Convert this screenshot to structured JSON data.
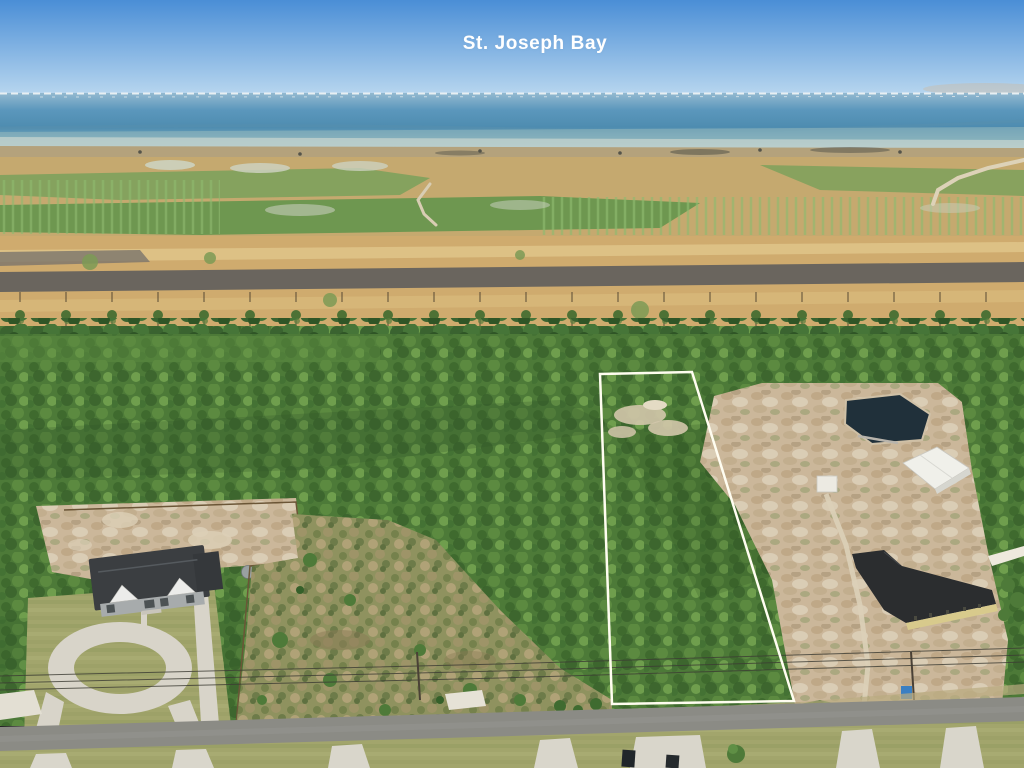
{
  "scene": {
    "type": "aerial-drone-photo",
    "title": "St. Joseph Bay",
    "subject": "Aerial view of a vacant wooded land parcel outlined in white, with St. Joseph Bay on the horizon, a house with circular driveway at lower left, cleared sand lots with metal buildings and a pond at right, and a paved road along the bottom"
  },
  "overlay": {
    "bay_label": "St. Joseph Bay",
    "boundary_points": "600,374 692,372 794,701 612,704"
  },
  "colors": {
    "sky_top": "#4a8ed6",
    "sky_horizon": "#b9d7ef",
    "water_far": "#93b9d0",
    "water_deep": "#4e8cb0",
    "water_nearshore": "#a9c6c6",
    "marsh_tan": "#cfab6e",
    "burned_strip": "#6a655e",
    "forest_green": "#4d7a38",
    "scrub_green": "#8f925f",
    "sand": "#cbb79a",
    "road_gray": "#8b8b85",
    "boundary_white": "#fffdf0",
    "label_white": "#ffffff",
    "pond_dark": "#20303a",
    "dark_roof": "#2b2d2f",
    "metal_building": "#f0f0ea",
    "house_roof": "#3b3e41"
  }
}
